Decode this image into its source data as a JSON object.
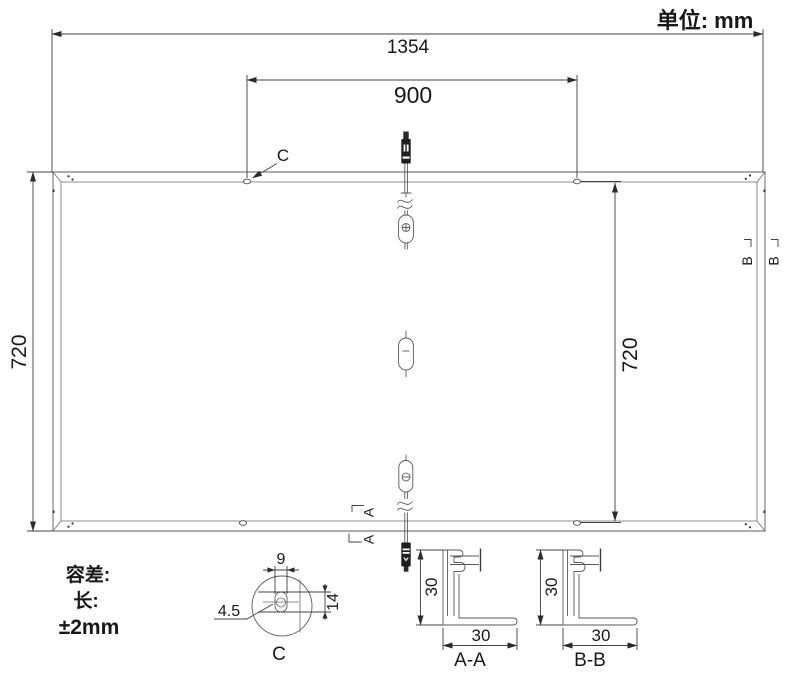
{
  "drawing": {
    "unit_label": "单位: mm",
    "dim_overall_width": "1354",
    "dim_mount_span": "900",
    "dim_height_left": "720",
    "dim_height_right": "720",
    "callout_c": "C",
    "tolerance": {
      "title": "容差:",
      "length_label": "长:",
      "value": "±2mm"
    },
    "detail_c": {
      "label": "C",
      "dim_width": "9",
      "dim_height": "14",
      "dim_hole": "4.5"
    },
    "section_a": {
      "marker": "A",
      "label": "A-A",
      "dim_height": "30",
      "dim_width": "30"
    },
    "section_b": {
      "marker": "B",
      "label": "B-B",
      "dim_height": "30",
      "dim_width": "30"
    }
  }
}
